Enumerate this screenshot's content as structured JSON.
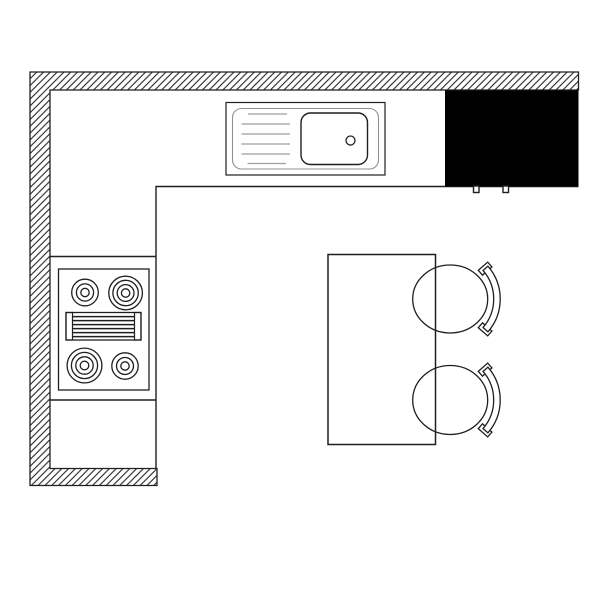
{
  "document": {
    "title": "Kitchen floor plan"
  },
  "colors": {
    "background": "#ffffff",
    "line": "#1f1f1f",
    "soft_line": "#9e9e9e",
    "surface": "#ffffff",
    "appliance_fill": "#000000"
  },
  "plan": {
    "type": "kitchen-floor-plan",
    "fixtures": {
      "wall": "hatched L-wall with bottom-left return",
      "counter": "L-shaped counter run",
      "sink": {
        "parts": [
          "drainboard",
          "basin",
          "drain"
        ]
      },
      "appliance": {
        "style": "solid black block",
        "feet": 2
      },
      "cooktop": {
        "burners": 4,
        "grill_lines": 6
      },
      "island_table": {
        "seats": 2
      },
      "chairs": 2
    }
  }
}
